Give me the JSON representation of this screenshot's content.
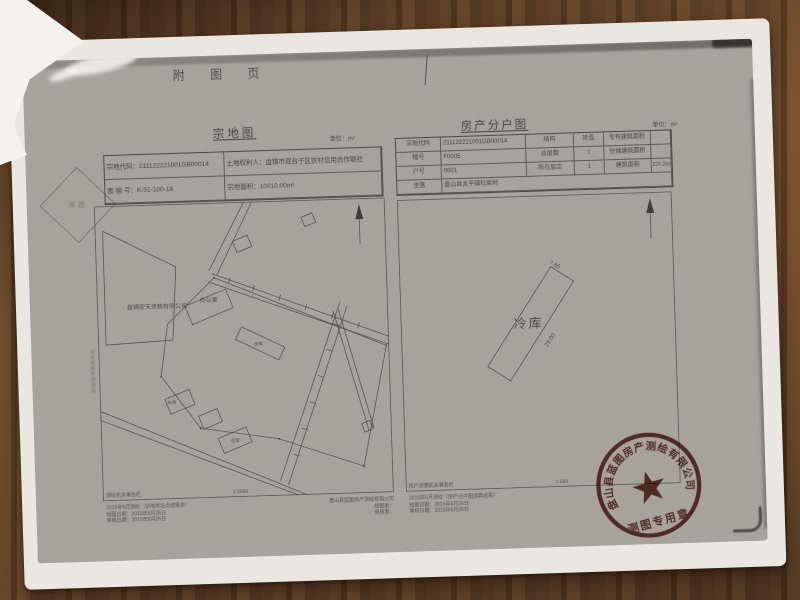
{
  "header": {
    "title": "附 图 页"
  },
  "parcel_map": {
    "title": "宗地图",
    "unit": "单位：m²",
    "info_rows": [
      {
        "left": "宗地代码：211122221001GB00014",
        "right": "土地权利人：盘锦市双台子区农村信用合作联社"
      },
      {
        "left": "图 幅 号：K-51-100-18",
        "right": "宗地面积：10010.00m²"
      }
    ],
    "plan": {
      "company": "盘锦宏天涂装有限公司",
      "office": "办公室",
      "garage": "车库",
      "warehouse": "仓库",
      "shed": "仓库",
      "scale": "1:2000"
    },
    "footer": {
      "org": "测绘机关署名栏",
      "lines": [
        "2015年6月测绘（宗地界址点成果表）",
        "绘图日期：2015年6月26日",
        "审核日期：2015年6月26日"
      ],
      "company": "盘山县蓝图房产测绘有限公司",
      "drafter": "绘图者：",
      "checker": "审核者："
    },
    "side_note": "测绘成果专用图纸"
  },
  "unit_plan": {
    "title": "房产分户图",
    "unit": "单位：m²",
    "table": {
      "rows": [
        {
          "l1": "宗地代码",
          "v1": "211122221001GB00014",
          "l2": "结构",
          "v2": "砖混",
          "l3": "专有建筑面积",
          "v3": ""
        },
        {
          "l1": "幢号",
          "v1": "F0005",
          "l2": "总层数",
          "v2": "1",
          "l3": "分摊建筑面积",
          "v3": ""
        },
        {
          "l1": "户号",
          "v1": "0001",
          "l2": "所在层次",
          "v2": "1",
          "l3": "建筑面积",
          "v3": "226.2m²"
        },
        {
          "l1": "坐落",
          "v1": "盘山县太平镇杜家村"
        }
      ]
    },
    "plan": {
      "building": "冷库",
      "dim_top": "7.80",
      "dim_side": "29.00",
      "scale": "1:500"
    },
    "footer": {
      "org": "房产测量机关署名栏",
      "lines": [
        "2015年6月测绘（房产分户图测算成果）",
        "绘图日期：2015年6月26日",
        "审核日期：2015年6月26日"
      ]
    }
  },
  "stamp": {
    "ring": "盘山县蓝图房产测绘有限公司",
    "banner": "测图专用章"
  },
  "marks": {
    "diamond": "审图"
  },
  "colors": {
    "stamp_red": "#6f332c",
    "toner_gray": "#a9a59c",
    "wood_brown": "#6b4629",
    "ink": "#47453f"
  }
}
